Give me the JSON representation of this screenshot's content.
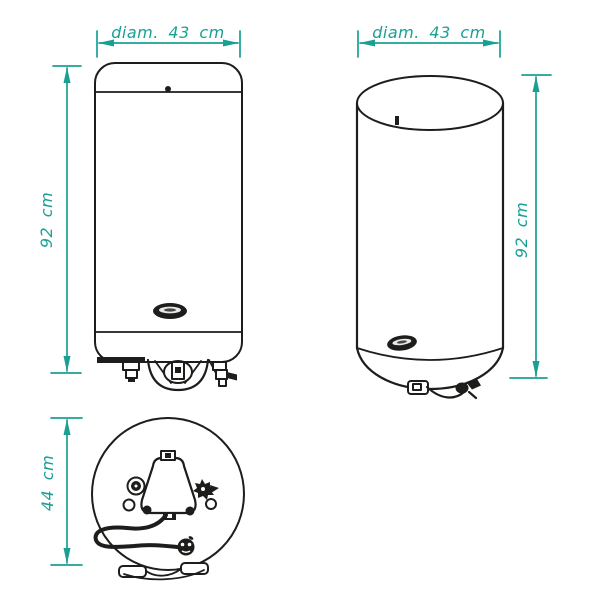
{
  "colors": {
    "accent": "#17a094",
    "line": "#1d1d1b",
    "background": "#ffffff"
  },
  "diagram": {
    "front": {
      "width_label": "diam. 43 cm",
      "height_label": "92 cm"
    },
    "side": {
      "width_label": "diam. 43 cm",
      "height_label": "92 cm"
    },
    "bottom": {
      "height_label": "44 cm"
    }
  }
}
